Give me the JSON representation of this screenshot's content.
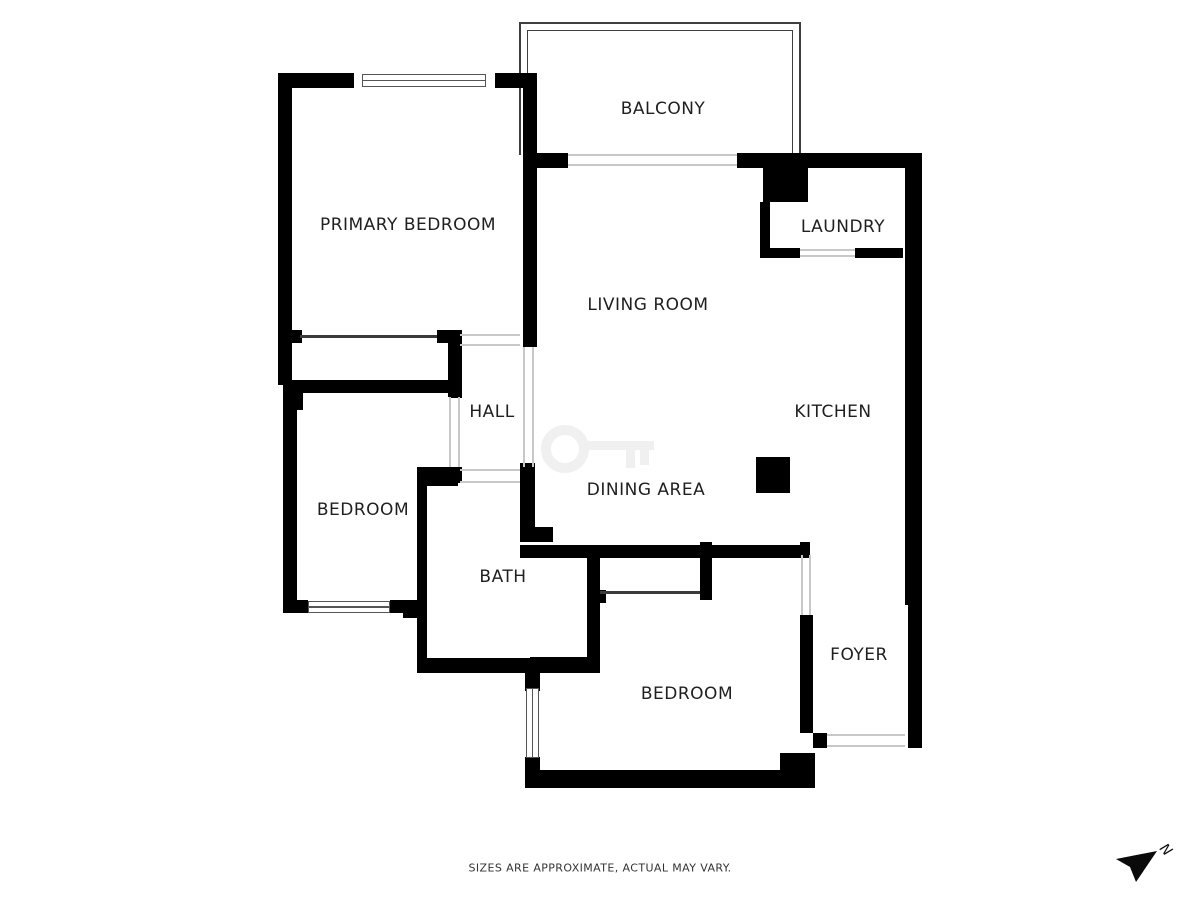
{
  "rooms": [
    {
      "id": "balcony",
      "label": "BALCONY"
    },
    {
      "id": "primary-bedroom",
      "label": "PRIMARY BEDROOM"
    },
    {
      "id": "laundry",
      "label": "LAUNDRY"
    },
    {
      "id": "living-room",
      "label": "LIVING ROOM"
    },
    {
      "id": "hall",
      "label": "HALL"
    },
    {
      "id": "kitchen",
      "label": "KITCHEN"
    },
    {
      "id": "dining-area",
      "label": "DINING AREA"
    },
    {
      "id": "bedroom-mid",
      "label": "BEDROOM"
    },
    {
      "id": "bath",
      "label": "BATH"
    },
    {
      "id": "foyer",
      "label": "FOYER"
    },
    {
      "id": "bedroom-bottom",
      "label": "BEDROOM"
    }
  ],
  "disclaimer": "SIZES ARE APPROXIMATE, ACTUAL MAY VARY.",
  "compass": {
    "label": "N"
  },
  "watermark": {
    "icon": "key-icon"
  },
  "colors": {
    "wall": "#000000",
    "opening_line": "#c8c8c8",
    "window_frame": "#555555",
    "railing": "#3f3f3f",
    "label_text": "#1f1f1f",
    "disclaimer_text": "#333333",
    "watermark": "#f0f0f0"
  }
}
